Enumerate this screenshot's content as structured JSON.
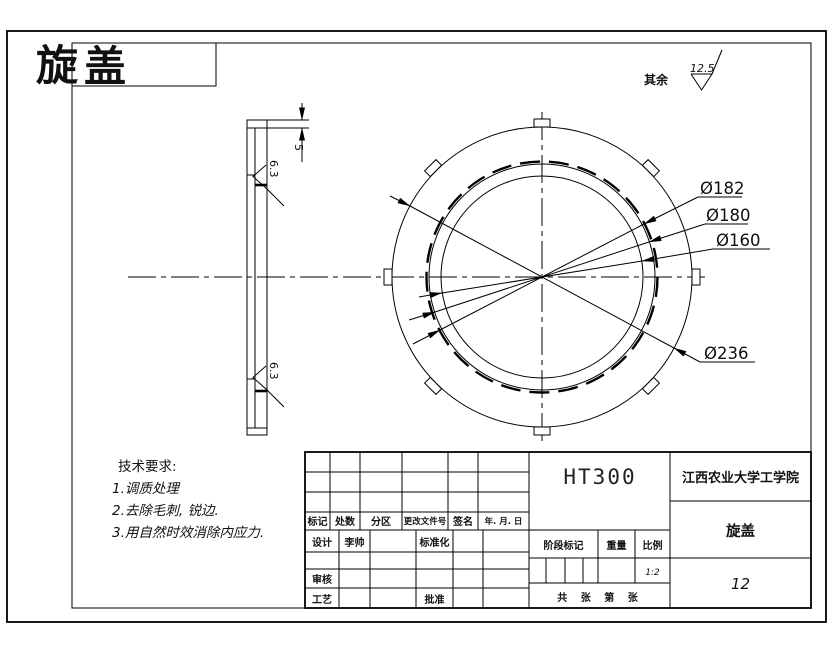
{
  "colors": {
    "line": "#000000",
    "accent_red": "#ff0000",
    "paper": "#ffffff"
  },
  "header": {
    "title_char_outside": "旋",
    "title_char_inside": "盖"
  },
  "general_roughness": {
    "label": "其余",
    "value": "12.5"
  },
  "side_view": {
    "thickness": "5",
    "roughness_upper": "6.3",
    "roughness_lower": "6.3"
  },
  "front_view": {
    "dia_182": "Ø182",
    "dia_180": "Ø180",
    "dia_160": "Ø160",
    "dia_236": "Ø236"
  },
  "tech_requirements": {
    "heading": "技术要求:",
    "items": [
      "1.调质处理",
      "2.去除毛刺, 锐边.",
      "3.用自然时效消除内应力."
    ]
  },
  "title_block": {
    "revision_headers": {
      "mark": "标记",
      "count": "处数",
      "zone": "分区",
      "change_doc_no": "更改文件号",
      "signature": "签名",
      "date": "年. 月. 日"
    },
    "roles": {
      "design": "设计",
      "check": "审核",
      "process": "工艺",
      "standardization": "标准化",
      "approve": "批准"
    },
    "designer_signature": "李帅",
    "stage_mark": "阶段标记",
    "weight": "重量",
    "scale": "比例",
    "scale_value": "1:2",
    "sheet_info": "共 张 第 张",
    "material": "HT300",
    "company": "江西农业大学工学院",
    "part_name": "旋盖",
    "drawing_number": "12"
  }
}
